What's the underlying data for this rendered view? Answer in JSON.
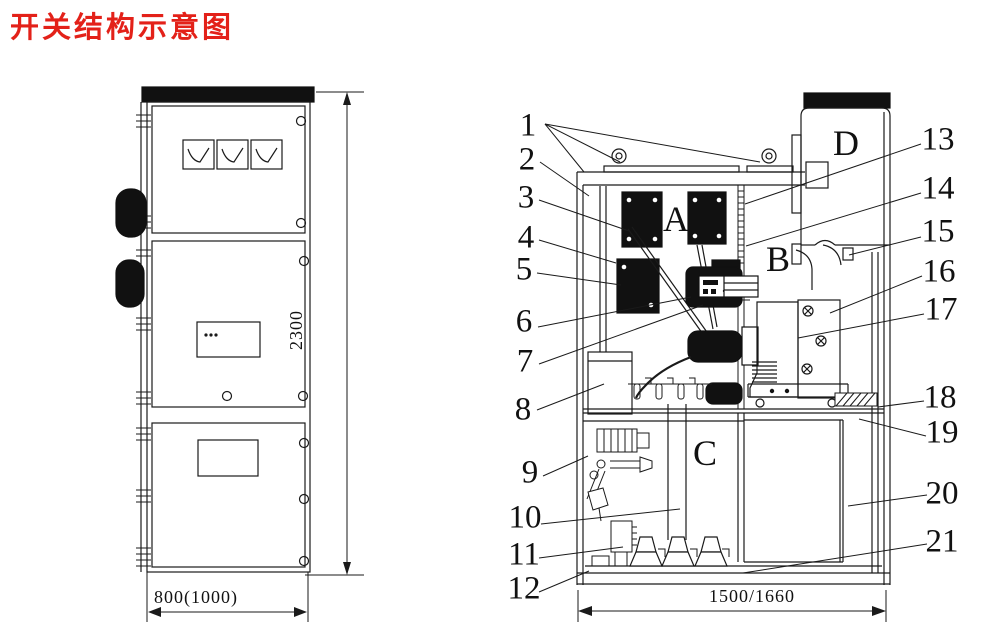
{
  "title": "开关结构示意图",
  "colors": {
    "title_red": "#e32119",
    "ink": "#1a1a1a"
  },
  "callouts": {
    "left": [
      "1",
      "2",
      "3",
      "4",
      "5",
      "6",
      "7",
      "8",
      "9",
      "10",
      "11",
      "12"
    ],
    "right": [
      "13",
      "14",
      "15",
      "16",
      "17",
      "18",
      "19",
      "20",
      "21"
    ]
  },
  "compartments": {
    "a": "A",
    "b": "B",
    "c": "C",
    "d": "D"
  },
  "dimensions": {
    "front_height": "2300",
    "front_width": "800(1000)",
    "side_width": "1500/1660"
  }
}
